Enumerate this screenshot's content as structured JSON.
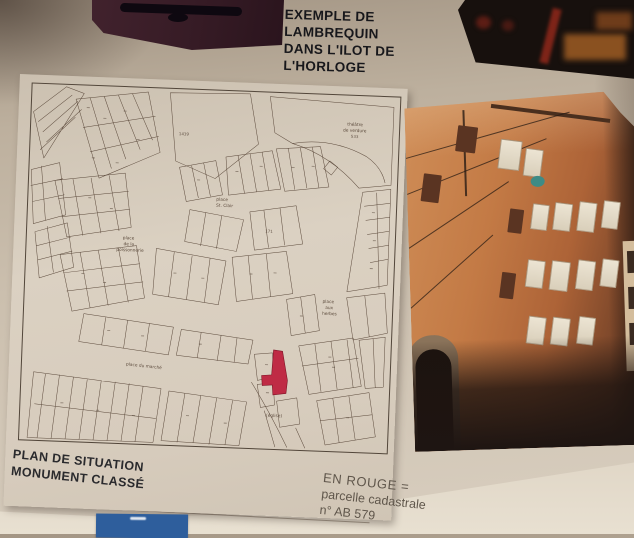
{
  "board": {
    "title_lines": [
      "EXEMPLE DE",
      "LAMBREQUIN",
      "DANS L'ILOT DE",
      "L'HORLOGE"
    ]
  },
  "map_sheet": {
    "caption_line1": "PLAN DE SITUATION",
    "caption_line2": "MONUMENT CLASSÉ",
    "labels": {
      "theatre_l1": "théâtre",
      "theatre_l2": "de verdure",
      "theatre_l3": "533",
      "big_parcel": "1439",
      "st_clair_l1": "place",
      "st_clair_l2": "St. Clair",
      "poisson_l1": "place",
      "poisson_l2": "de la",
      "poisson_l3": "poissonnerie",
      "marche": "place du marché",
      "herbes_l1": "place",
      "herbes_l2": "aux",
      "herbes_l3": "herbes",
      "eglise": "(église)",
      "parcel_171": "171"
    }
  },
  "legend": {
    "line1": "EN ROUGE =",
    "line2": "parcelle cadastrale",
    "line3": "n° AB 579"
  },
  "colors": {
    "red_parcel": "#bf2b45",
    "blue_card": "#2e5e9c",
    "facade_orange": "#c37a45",
    "board_beige": "#cbbfae"
  }
}
